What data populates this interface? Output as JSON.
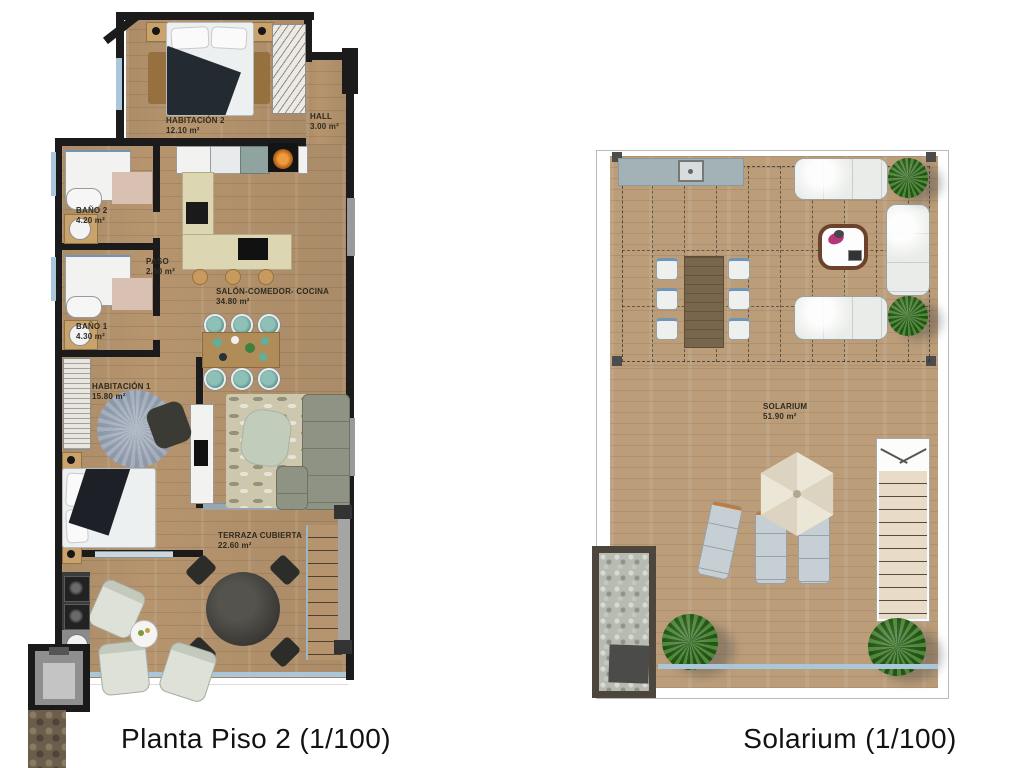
{
  "document": {
    "type": "architectural floor plans",
    "background": "#ffffff"
  },
  "plans": {
    "left": {
      "caption": "Planta Piso 2 (1/100)",
      "rooms": {
        "habitacion2": {
          "name": "HABITACIÓN 2",
          "area": "12.10 m²"
        },
        "hall": {
          "name": "HALL",
          "area": "3.00 m²"
        },
        "bano2": {
          "name": "BAÑO 2",
          "area": "4.20 m²"
        },
        "paso": {
          "name": "PASO",
          "area": "2.50 m²"
        },
        "salon": {
          "name": "SALÓN-COMEDOR- COCINA",
          "area": "34.80 m²"
        },
        "bano1": {
          "name": "BAÑO 1",
          "area": "4.30 m²"
        },
        "habitacion1": {
          "name": "HABITACIÓN 1",
          "area": "15.80 m²"
        },
        "terraza": {
          "name": "TERRAZA CUBIERTA",
          "area": "22.60 m²"
        }
      }
    },
    "right": {
      "caption": "Solarium (1/100)",
      "rooms": {
        "solarium": {
          "name": "SOLARIUM",
          "area": "51.90 m²"
        }
      }
    }
  },
  "colors": {
    "wall": "#1b1b1b",
    "wood_floor": "#b5946e",
    "solarium_floor": "#bb9d79",
    "kitchen_counter": "#dcd6b2",
    "sofa_green": "#8e9383",
    "sofa_white": "#e9ece8",
    "plant_green": "#4c8a33",
    "railing_blue": "#aac6da",
    "parasol_cream": "#ece6d6",
    "label_text": "#2e2b20"
  }
}
